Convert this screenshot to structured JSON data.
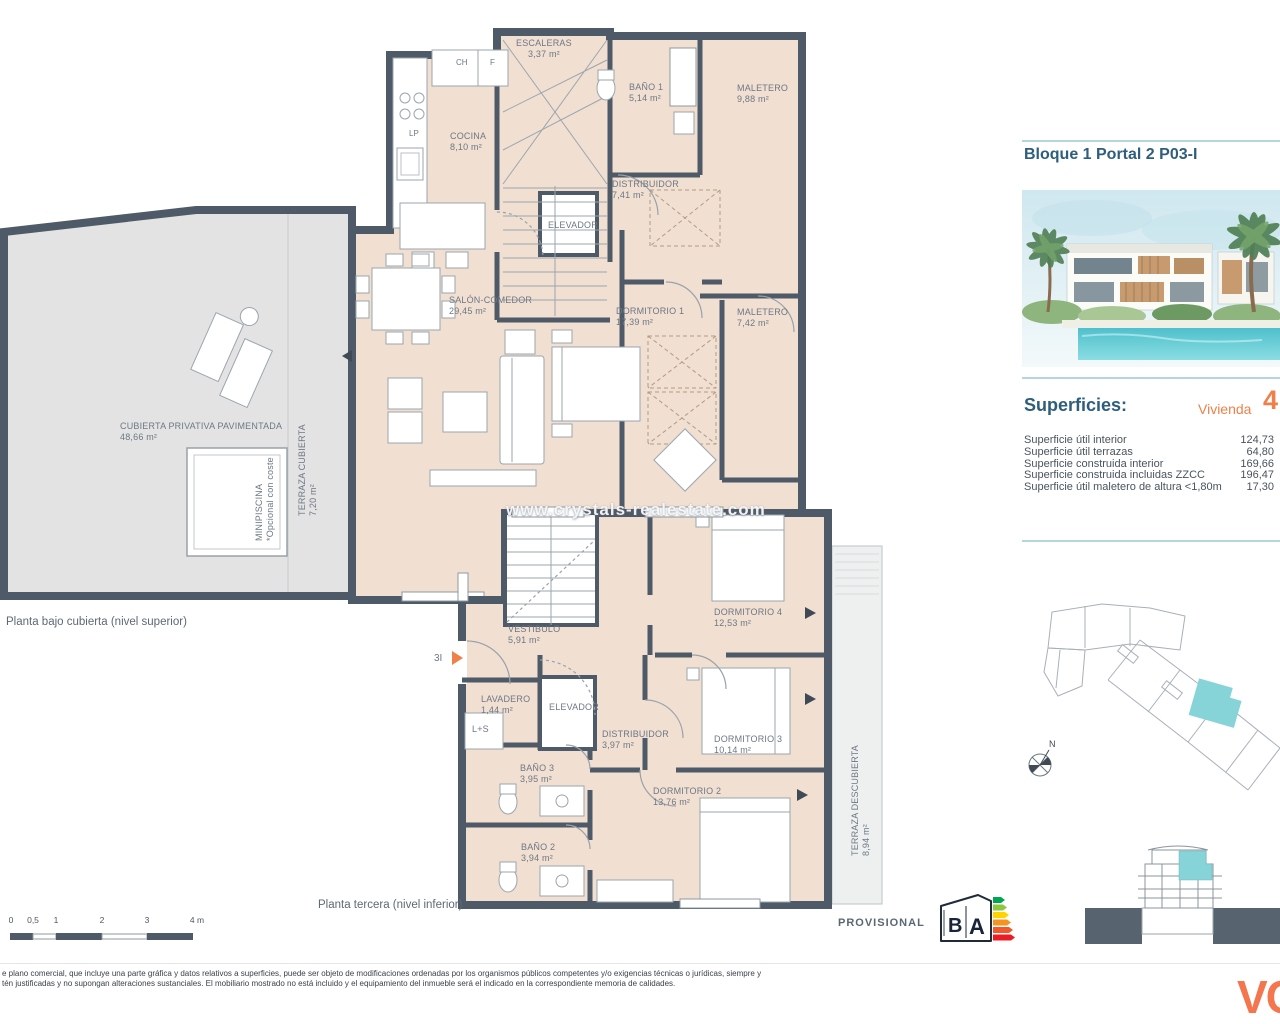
{
  "header": {
    "title": "Bloque 1 Portal 2 P03-I"
  },
  "watermark": "www.crystals-realestate.com",
  "superficies": {
    "heading": "Superficies:",
    "vivienda_label": "Vivienda",
    "vivienda_number": "4",
    "rows": [
      {
        "label": "Superficie útil interior",
        "value": "124,73"
      },
      {
        "label": "Superficie útil terrazas",
        "value": "64,80"
      },
      {
        "label": "Superficie construida interior",
        "value": "169,66"
      },
      {
        "label": "Superficie construida incluidas ZZCC",
        "value": "196,47"
      },
      {
        "label": "Superficie útil maletero de altura <1,80m",
        "value": "17,30"
      }
    ]
  },
  "upper_plan": {
    "caption": "Planta bajo cubierta (nivel superior)",
    "rooms": {
      "escaleras": {
        "name": "ESCALERAS",
        "area": "3,37 m²"
      },
      "cocina": {
        "name": "COCINA",
        "area": "8,10 m²"
      },
      "bano1": {
        "name": "BAÑO 1",
        "area": "5,14 m²"
      },
      "maletero_top": {
        "name": "MALETERO",
        "area": "9,88 m²"
      },
      "distribuidor": {
        "name": "DISTRIBUIDOR",
        "area": "7,41 m²"
      },
      "elevador": {
        "name": "ELEVADOR"
      },
      "salon": {
        "name": "SALÓN-COMEDOR",
        "area": "29,45 m²"
      },
      "dormitorio1": {
        "name": "DORMITORIO 1",
        "area": "17,39 m²"
      },
      "maletero_mid": {
        "name": "MALETERO",
        "area": "7,42 m²"
      },
      "cubierta": {
        "name": "CUBIERTA PRIVATIVA PAVIMENTADA",
        "area": "48,66 m²"
      },
      "terraza_cubierta": {
        "name": "TERRAZA CUBIERTA",
        "area": "7,20 m²"
      },
      "minipiscina": {
        "name": "MINIPISCINA",
        "note": "*Opcional con coste"
      }
    },
    "appliances": {
      "ch": "CH",
      "f": "F",
      "lp": "LP"
    }
  },
  "lower_plan": {
    "caption": "Planta tercera (nivel inferior)",
    "entrance": "3I",
    "rooms": {
      "vestibulo": {
        "name": "VESTIBULO",
        "area": "5,91 m²"
      },
      "dormitorio4": {
        "name": "DORMITORIO 4",
        "area": "12,53 m²"
      },
      "lavadero": {
        "name": "LAVADERO",
        "area": "1,44 m²"
      },
      "ls": {
        "name": "L+S"
      },
      "elevador": {
        "name": "ELEVADOR"
      },
      "distribuidor": {
        "name": "DISTRIBUIDOR",
        "area": "3,97 m²"
      },
      "dormitorio3": {
        "name": "DORMITORIO 3",
        "area": "10,14 m²"
      },
      "bano3": {
        "name": "BAÑO 3",
        "area": "3,95 m²"
      },
      "dormitorio2": {
        "name": "DORMITORIO 2",
        "area": "13,76 m²"
      },
      "bano2": {
        "name": "BAÑO 2",
        "area": "3,94 m²"
      },
      "terraza_descubierta": {
        "name": "TERRAZA DESCUBIERTA",
        "area": "8,94 m²"
      }
    }
  },
  "scalebar": {
    "labels": [
      "0",
      "0,5",
      "1",
      "2",
      "3",
      "4 m"
    ]
  },
  "energy": {
    "status": "PROVISIONAL",
    "letter_left": "B",
    "letter_right": "A"
  },
  "compass": {
    "north": "N"
  },
  "footer": {
    "disclaimer_line1": "e plano comercial, que incluye una parte gráfica y datos relativos a superficies, puede ser objeto de modificaciones ordenadas por los organismos públicos competentes y/o exigencias técnicas o jurídicas, siempre y",
    "disclaimer_line2": "tén justificadas y no supongan alteraciones sustanciales. El mobiliario mostrado no está incluido y el equipamiento del inmueble será el indicado en la correspondiente memoria de calidades.",
    "logo": "VC"
  },
  "colors": {
    "wall": "#4e5a67",
    "room_fill": "#f1dfd2",
    "terrace_fill": "#e3e3e3",
    "accent_orange": "#ef8049",
    "accent_teal": "#86d3d8",
    "heading_blue": "#2d5e7d"
  }
}
